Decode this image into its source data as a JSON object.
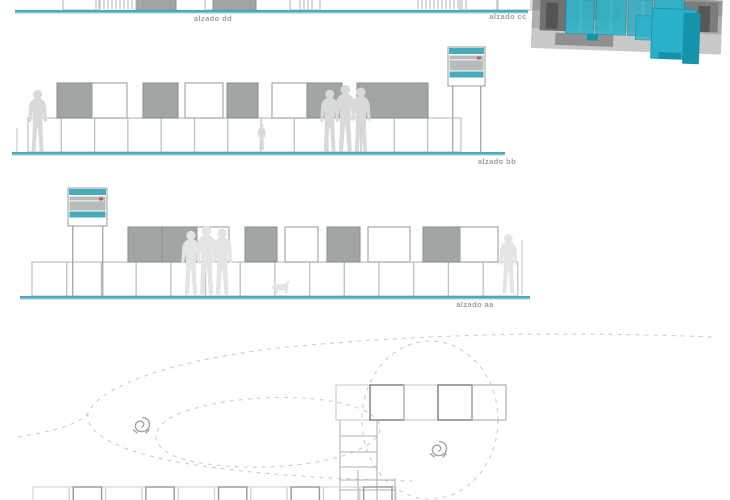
{
  "sheet": {
    "title": "modular cube pavilion drawings"
  },
  "palette": {
    "teal": "#46acb9",
    "teal_halo": "#b9e0e5",
    "cyan": "#29b1c9",
    "cyan_dark": "#1593ab",
    "cube_fill": "#a2a5a6",
    "cube_stroke_dark": "#8f9294",
    "cube_stroke_mid": "#9fa1a2",
    "cube_stroke_light": "#c0c2c3",
    "silhouette": "#d7d9da",
    "silhouette_light": "#e2e4e5",
    "label": "#9c9ea0",
    "dash": "#cbcdce",
    "red_accent": "#c0604f"
  },
  "labels": {
    "dd": "alzado dd",
    "cc": "alzado cc",
    "bb": "alzado bb",
    "aa": "alzado aa"
  },
  "label_pos": {
    "dd": {
      "x": 213,
      "y": 14
    },
    "cc": {
      "x": 508,
      "y": 12
    },
    "bb": {
      "x": 497,
      "y": 157
    },
    "aa": {
      "x": 475,
      "y": 300
    }
  },
  "top_strip": {
    "ground": {
      "x1": 15,
      "x2": 528,
      "y": 10
    },
    "frames": [
      {
        "x": 63,
        "w": 36
      },
      {
        "x": 205,
        "w": 36
      },
      {
        "x": 290,
        "w": 30
      },
      {
        "x": 460,
        "w": 38
      },
      {
        "x": 497,
        "w": 34
      }
    ],
    "grey_fragments": [
      {
        "x": 136,
        "w": 40
      },
      {
        "x": 213,
        "w": 43
      }
    ],
    "hatches": [
      {
        "x": 96,
        "w": 46
      },
      {
        "x": 300,
        "w": 14
      },
      {
        "x": 418,
        "w": 50
      }
    ]
  },
  "elevations": {
    "bb": {
      "ground": {
        "x1": 12,
        "x2": 505,
        "y": 152
      },
      "bottom_row": {
        "start": 28,
        "count": 13,
        "w": 33.3,
        "y": 118,
        "h": 34
      },
      "top_row_y": 83,
      "top_row_h": 35,
      "top_cubes": [
        {
          "x": 57,
          "w": 35,
          "grey": true
        },
        {
          "x": 92,
          "w": 35,
          "grey": false
        },
        {
          "x": 143,
          "w": 35,
          "grey": true
        },
        {
          "x": 185,
          "w": 38,
          "grey": false
        },
        {
          "x": 227,
          "w": 31,
          "grey": true
        },
        {
          "x": 272,
          "w": 35,
          "grey": false
        },
        {
          "x": 307,
          "w": 35,
          "grey": true
        },
        {
          "x": 357,
          "w": 71,
          "grey": true
        }
      ],
      "sign": {
        "x": 448,
        "y": 47,
        "w": 37,
        "h": 39,
        "leg_bottom": 152
      },
      "people": [
        {
          "type": "adult",
          "x": 29,
          "feet": 152,
          "h": 62,
          "light": false
        },
        {
          "type": "group3",
          "x": 321,
          "feet": 152,
          "h": 67,
          "light": false
        },
        {
          "type": "child",
          "x": 258,
          "feet": 150,
          "h": 26,
          "light": false
        }
      ],
      "sapling": {
        "x": 17,
        "y1": 128,
        "y2": 152
      }
    },
    "aa": {
      "ground": {
        "x1": 20,
        "x2": 530,
        "y": 296
      },
      "bottom_row": {
        "start": 32,
        "count": 14,
        "w": 34.7,
        "y": 262,
        "h": 34
      },
      "top_row_y": 227,
      "top_row_h": 35,
      "top_cubes": [
        {
          "x": 128,
          "w": 34,
          "grey": true
        },
        {
          "x": 162,
          "w": 35,
          "grey": true
        },
        {
          "x": 197,
          "w": 32,
          "grey": false
        },
        {
          "x": 245,
          "w": 32,
          "grey": true
        },
        {
          "x": 285,
          "w": 33,
          "grey": false
        },
        {
          "x": 327,
          "w": 33,
          "grey": true
        },
        {
          "x": 368,
          "w": 42,
          "grey": false
        },
        {
          "x": 423,
          "w": 37,
          "grey": true
        },
        {
          "x": 460,
          "w": 38,
          "grey": false
        }
      ],
      "sign": {
        "x": 68,
        "y": 188,
        "w": 39,
        "h": 38,
        "leg_bottom": 296
      },
      "people": [
        {
          "type": "group3",
          "x": 182,
          "feet": 295,
          "h": 69,
          "light": true
        },
        {
          "type": "dog",
          "x": 271,
          "feet": 294,
          "h": 14,
          "light": true
        },
        {
          "type": "adult",
          "x": 500,
          "feet": 294,
          "h": 60,
          "light": true
        }
      ],
      "sapling": {
        "x": 522,
        "y1": 240,
        "y2": 295
      }
    }
  },
  "plan": {
    "curves": [
      "M18 437 C55 431 80 424 88 413 C100 385 180 357 298 346 C430 334 560 331 712 337",
      "M88 413 C84 436 128 455 196 465 C268 476 345 479 412 481",
      "M186 411 C235 395 310 393 352 406 C392 418 390 441 342 456 C288 472 206 470 172 455 C146 442 152 423 186 411 Z"
    ],
    "ellipse": {
      "cx": 430,
      "cy": 420,
      "rx": 68,
      "ry": 79
    },
    "row_squares": {
      "y": 385,
      "w": 34,
      "h": 35,
      "items": [
        {
          "x": 336,
          "s": "light"
        },
        {
          "x": 370,
          "s": "dark"
        },
        {
          "x": 404,
          "s": "light"
        },
        {
          "x": 438,
          "s": "dark"
        },
        {
          "x": 472,
          "s": "mid"
        }
      ]
    },
    "ladder": {
      "rails": [
        {
          "x": 340,
          "y1": 420,
          "y2": 500
        },
        {
          "x": 377,
          "y1": 420,
          "y2": 500
        },
        {
          "x": 358,
          "y1": 470,
          "y2": 500
        },
        {
          "x": 395,
          "y1": 478,
          "y2": 500
        }
      ],
      "rungs": [
        {
          "y": 436,
          "x1": 340,
          "x2": 377
        },
        {
          "y": 452,
          "x1": 340,
          "x2": 377
        },
        {
          "y": 467,
          "x1": 340,
          "x2": 377
        },
        {
          "y": 480,
          "x1": 340,
          "x2": 395
        },
        {
          "y": 490,
          "x1": 340,
          "x2": 395
        }
      ]
    },
    "bottom_row": {
      "y": 487,
      "start": 33,
      "count": 10,
      "w": 36.3,
      "dark_indices": [
        1,
        3,
        5,
        7,
        9
      ]
    },
    "figures": [
      {
        "x": 133,
        "y": 416
      },
      {
        "x": 430,
        "y": 440
      }
    ]
  },
  "photo": {
    "x": 533,
    "y": -12,
    "rotate": 2,
    "w": 190,
    "h": 70,
    "grey_blocks": [
      {
        "x": 0,
        "y": 6,
        "w": 190,
        "h": 52,
        "f": "#aeb0b0"
      },
      {
        "x": 0,
        "y": 6,
        "w": 190,
        "h": 16,
        "f": "#989a9a"
      },
      {
        "x": 0,
        "y": 40,
        "w": 190,
        "h": 20,
        "f": "#c8caca"
      },
      {
        "x": 8,
        "y": 10,
        "w": 26,
        "h": 32,
        "f": "#707272"
      },
      {
        "x": 14,
        "y": 14,
        "w": 12,
        "h": 26,
        "f": "#525454"
      },
      {
        "x": 36,
        "y": 8,
        "w": 52,
        "h": 22,
        "f": "#8f9191"
      },
      {
        "x": 92,
        "y": 8,
        "w": 34,
        "h": 20,
        "f": "#a3a5a5"
      },
      {
        "x": 148,
        "y": 8,
        "w": 38,
        "h": 30,
        "f": "#7c7e7e"
      },
      {
        "x": 166,
        "y": 12,
        "w": 12,
        "h": 26,
        "f": "#565858"
      },
      {
        "x": 24,
        "y": 44,
        "w": 58,
        "h": 12,
        "f": "#8f9191"
      }
    ],
    "cyan_blocks": [
      {
        "x": 34,
        "y": 10,
        "w": 28,
        "h": 34,
        "o": 0.85,
        "dark": false
      },
      {
        "x": 64,
        "y": 6,
        "w": 30,
        "h": 38,
        "o": 0.85,
        "dark": false
      },
      {
        "x": 96,
        "y": 8,
        "w": 24,
        "h": 36,
        "o": 0.8,
        "dark": false
      },
      {
        "x": 122,
        "y": 4,
        "w": 30,
        "h": 42,
        "o": 0.9,
        "dark": false
      },
      {
        "x": 104,
        "y": 24,
        "w": 46,
        "h": 24,
        "o": 0.75,
        "dark": false
      },
      {
        "x": 120,
        "y": 16,
        "w": 44,
        "h": 50,
        "o": 1,
        "dark": false
      },
      {
        "x": 152,
        "y": 20,
        "w": 16,
        "h": 50,
        "o": 1,
        "dark": true
      },
      {
        "x": 128,
        "y": 60,
        "w": 22,
        "h": 6,
        "o": 1,
        "dark": true
      },
      {
        "x": 56,
        "y": 44,
        "w": 10,
        "h": 6,
        "o": 1,
        "dark": true
      }
    ],
    "white_lines": [
      {
        "x": 48,
        "y": 10,
        "h": 32
      },
      {
        "x": 78,
        "y": 8,
        "h": 36
      },
      {
        "x": 110,
        "y": 10,
        "h": 34
      }
    ]
  }
}
